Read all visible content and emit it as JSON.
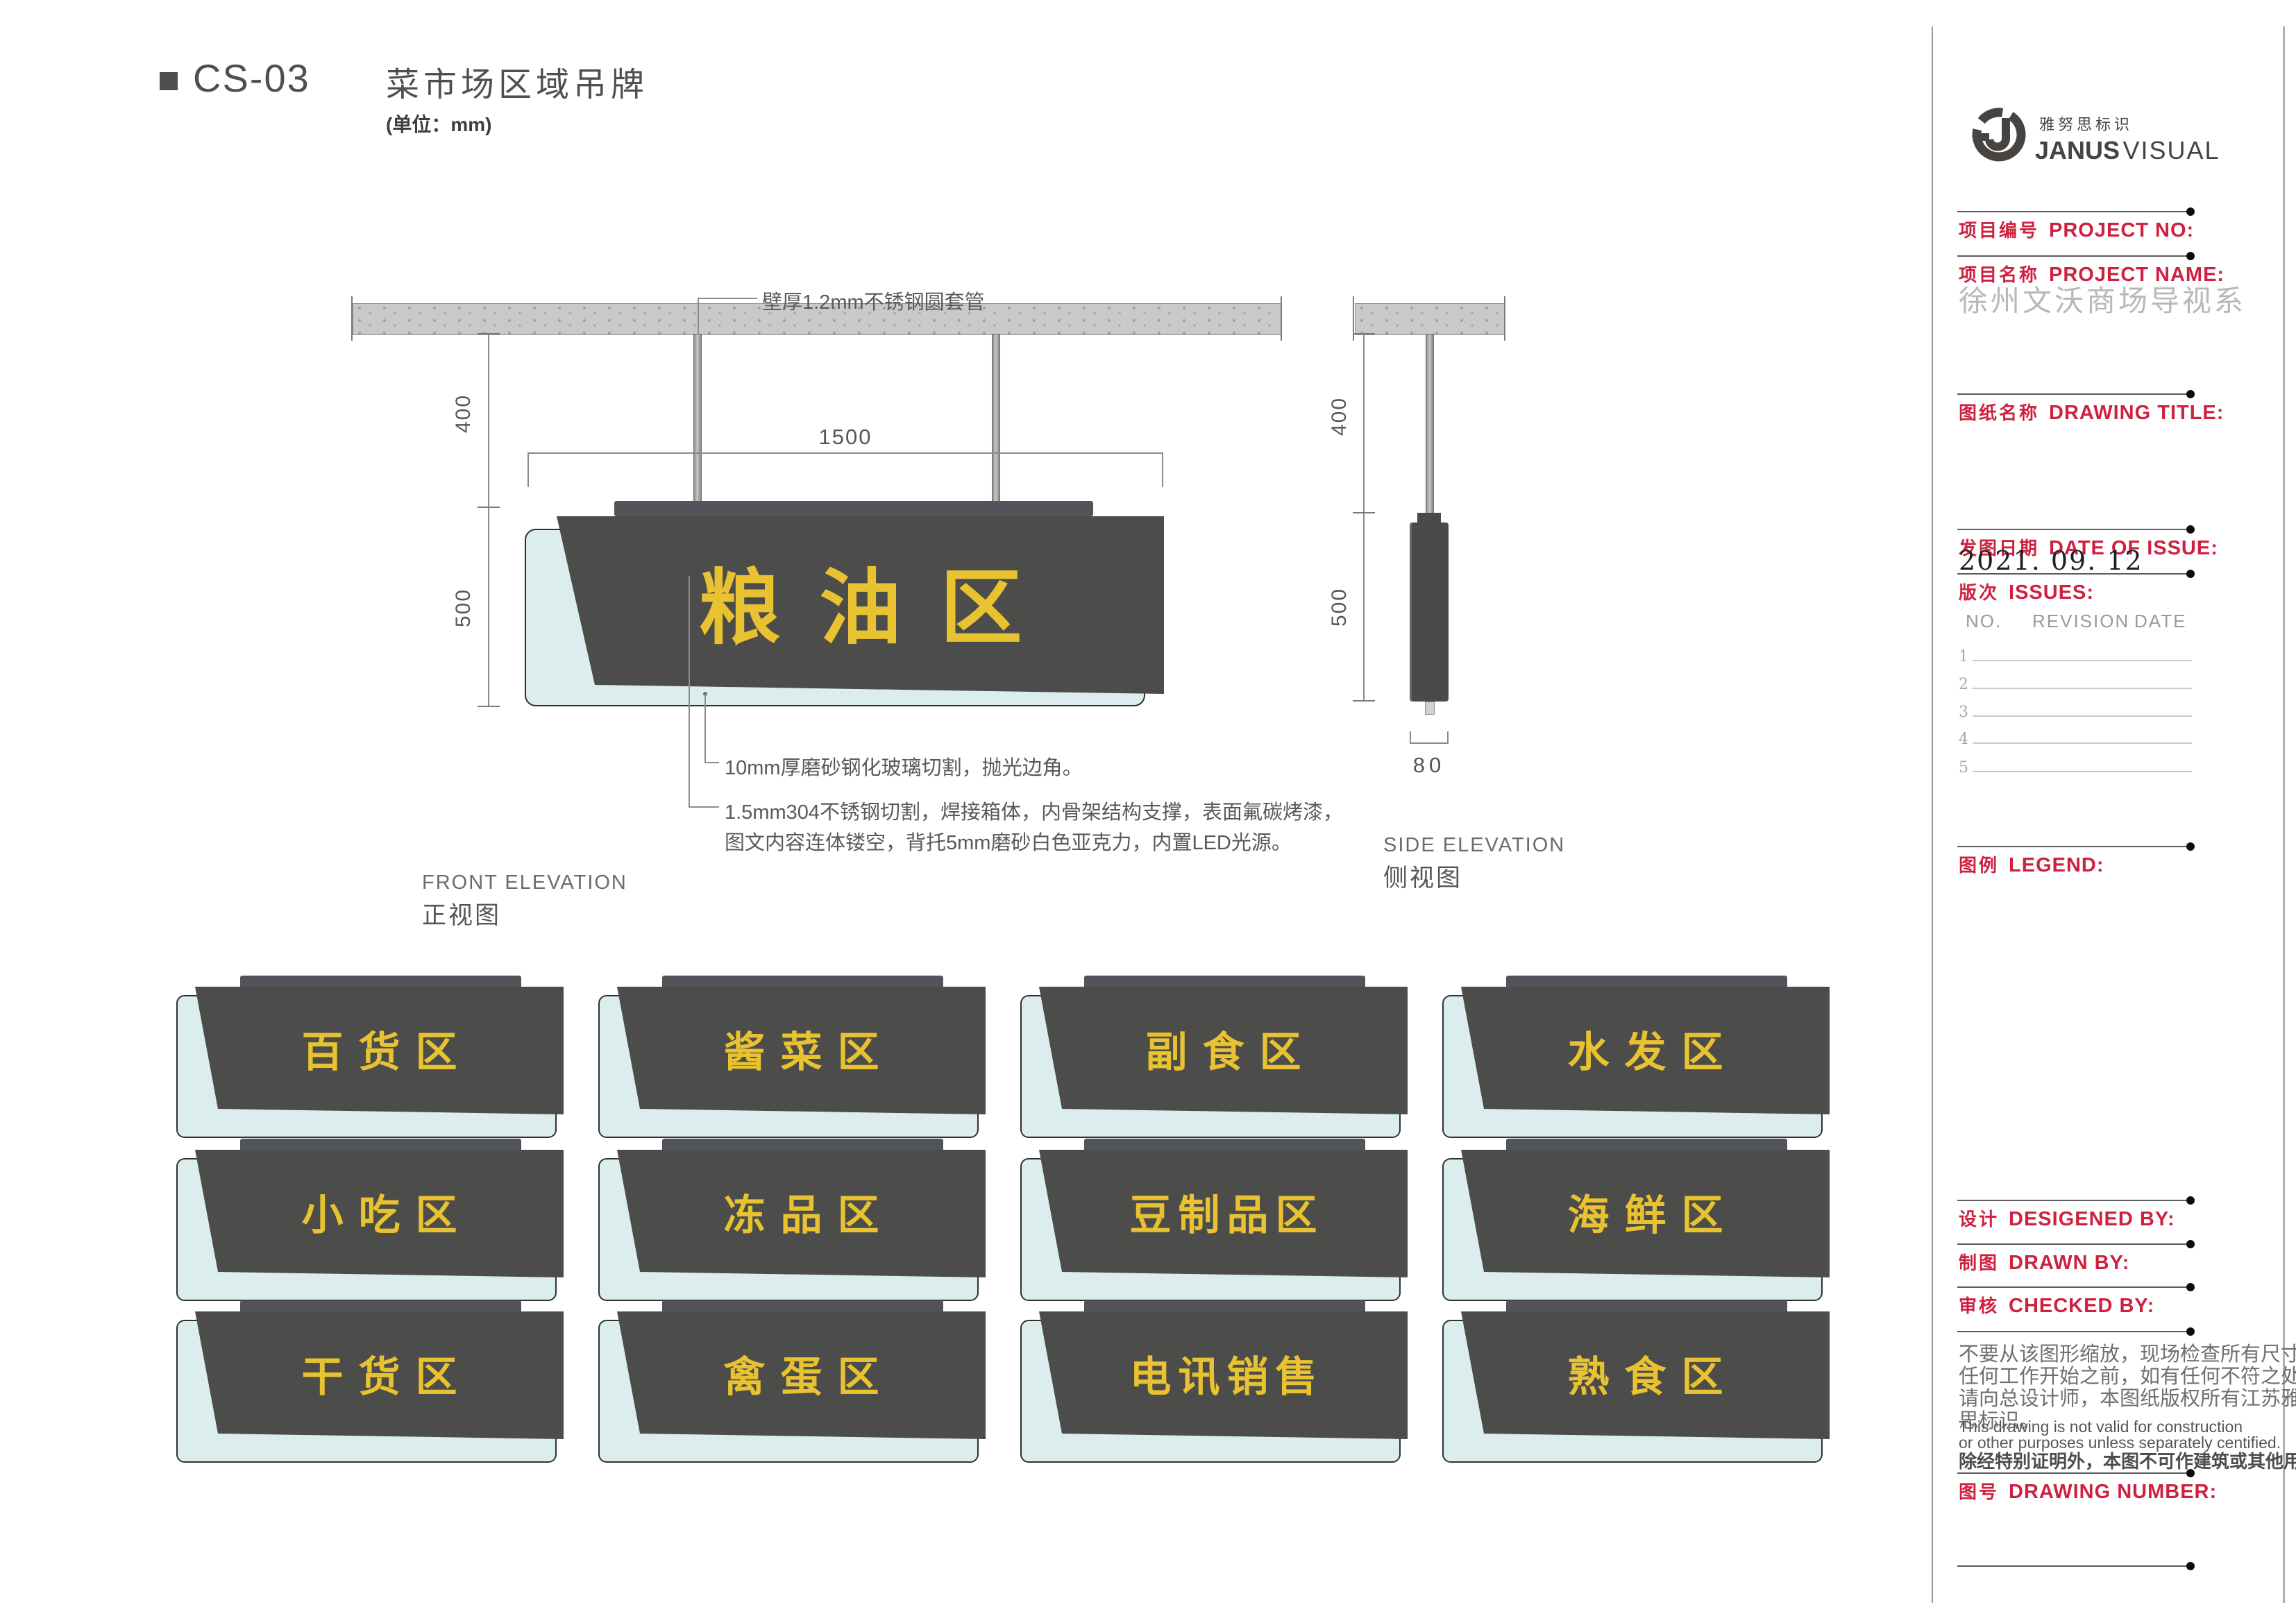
{
  "page": {
    "code": "CS-03",
    "title": "菜市场区域吊牌",
    "unit": "(单位：mm)"
  },
  "front": {
    "label_en": "FRONT ELEVATION",
    "label_cn": "正视图",
    "sign_text": "粮油区",
    "dim_hang": "400",
    "dim_height": "500",
    "dim_width": "1500",
    "note_pipe": "壁厚1.2mm不锈钢圆套管",
    "note_glass": "10mm厚磨砂钢化玻璃切割，抛光边角。",
    "note_steel_1": "1.5mm304不锈钢切割，焊接箱体，内骨架结构支撑，表面氟碳烤漆，",
    "note_steel_2": "图文内容连体镂空，背托5mm磨砂白色亚克力，内置LED光源。"
  },
  "side": {
    "label_en": "SIDE ELEVATION",
    "label_cn": "侧视图",
    "dim_hang": "400",
    "dim_height": "500",
    "dim_depth": "80"
  },
  "signs": [
    "百货区",
    "酱菜区",
    "副食区",
    "水发区",
    "小吃区",
    "冻品区",
    "豆制品区",
    "海鲜区",
    "干货区",
    "禽蛋区",
    "电讯销售",
    "熟食区"
  ],
  "title_block": {
    "brand_cn": "雅努思标识",
    "brand_en_bold": "JANUS",
    "brand_en_light": "VISUAL",
    "project_no_cn": "项目编号",
    "project_no_en": "PROJECT NO:",
    "project_name_cn": "项目名称",
    "project_name_en": "PROJECT NAME:",
    "project_name_value": "徐州文沃商场导视系",
    "drawing_title_cn": "图纸名称",
    "drawing_title_en": "DRAWING TITLE:",
    "date_cn": "发图日期",
    "date_en": "DATE OF ISSUE:",
    "date_value": "2021. 09. 12",
    "issues_cn": "版次",
    "issues_en": "ISSUES:",
    "issues_headers": [
      "NO.",
      "REVISION",
      "DATE"
    ],
    "issue_rows": [
      "1",
      "2",
      "3",
      "4",
      "5"
    ],
    "legend_cn": "图例",
    "legend_en": "LEGEND:",
    "designed_cn": "设计",
    "designed_en": "DESIGENED BY:",
    "drawn_cn": "制图",
    "drawn_en": "DRAWN BY:",
    "checked_cn": "审核",
    "checked_en": "CHECKED BY:",
    "drawing_no_cn": "图号",
    "drawing_no_en": "DRAWING NUMBER:",
    "disclaimer_cn": [
      "不要从该图形缩放，现场检查所有尺寸在",
      "任何工作开始之前，如有任何不符之处，",
      "请向总设计师，本图纸版权所有江苏雅努",
      "思标识。"
    ],
    "disclaimer_en": [
      "This drawing is not valid for construction",
      "or other purposes unless separately centified."
    ],
    "disclaimer_last": "除经特别证明外，本图不可作建筑或其他用途。"
  },
  "colors": {
    "accent_yellow": "#e8c231",
    "panel_dark": "#4c4c4a",
    "glass_blue": "#dcedee",
    "ceiling_gray": "#c9c9c7",
    "label_red": "#ce2140"
  }
}
